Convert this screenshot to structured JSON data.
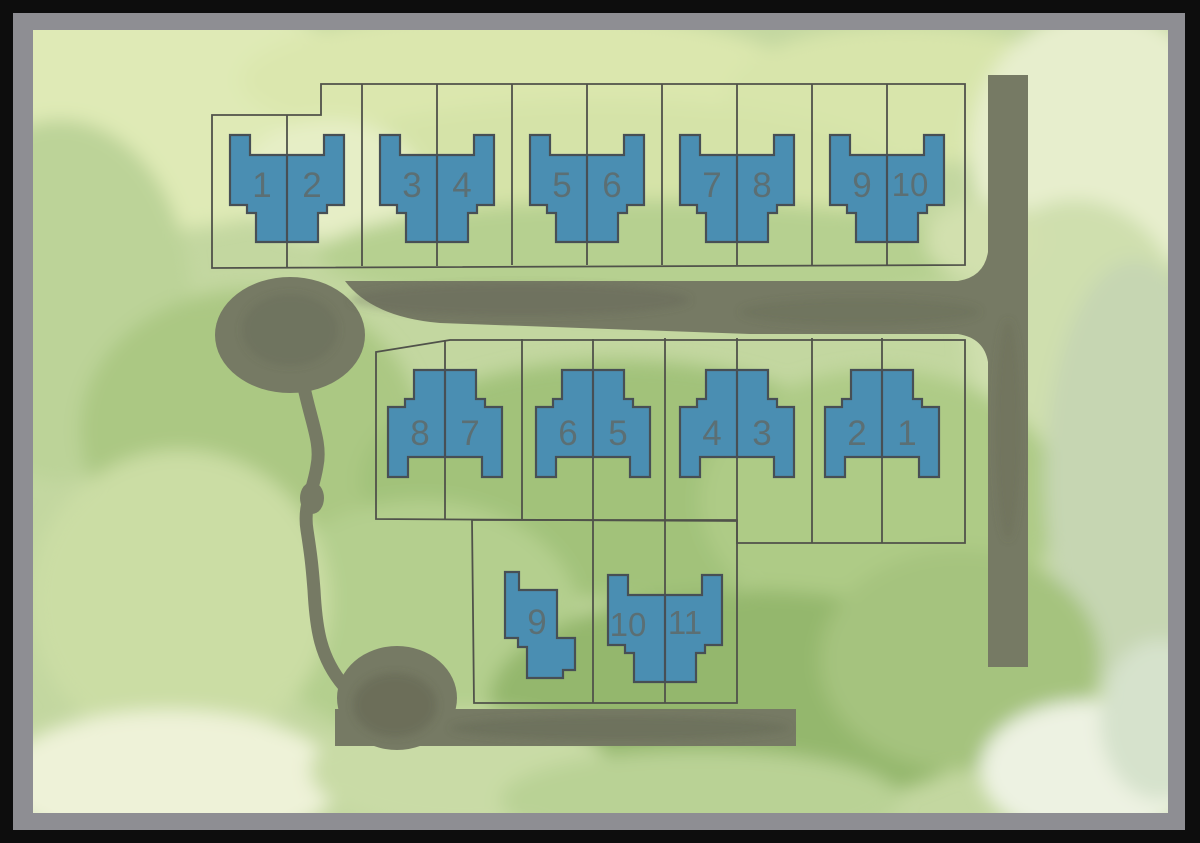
{
  "map": {
    "type": "residential-site-plan",
    "lots": {
      "top_row": [
        "1",
        "2",
        "3",
        "4",
        "5",
        "6",
        "7",
        "8",
        "9",
        "10"
      ],
      "middle_row": [
        "8",
        "7",
        "6",
        "5",
        "4",
        "3",
        "2",
        "1"
      ],
      "bottom_row": [
        "9",
        "10",
        "11"
      ]
    },
    "counts": {
      "top_row": 10,
      "middle_row": 8,
      "bottom_row": 3
    },
    "colors": {
      "outer_border": "#0d0d0d",
      "frame": "#8e8e93",
      "ground_base": "#c3d7a0",
      "road": "#767a64",
      "lot_line": "#50524a",
      "house_fill": "#4a8eb2",
      "house_stroke": "#474f55",
      "number": "#5f6a6a"
    }
  }
}
